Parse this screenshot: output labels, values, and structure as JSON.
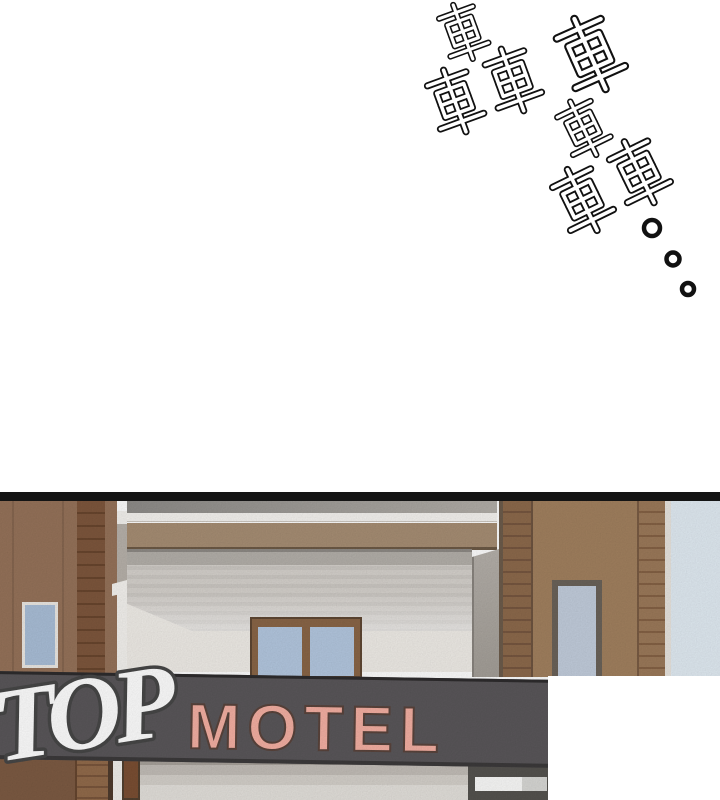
{
  "page": {
    "background": "#ffffff"
  },
  "sfx": {
    "text": "轟車轟",
    "label": "rumble sound effect 轟車轟 with trailing dots",
    "dots": 3
  },
  "panel": {
    "sign": {
      "script_word": "TOP",
      "word": "MOTEL"
    },
    "colors": {
      "sign_band": "#5a575a",
      "sign_letters": "#f5b0a3",
      "script_letters": "#ffffff",
      "brick": "#8d6a4c",
      "tan_wall": "#a2815f",
      "canopy": "#d6d2cd",
      "sky": "#e2ecf4",
      "window_glass": "#b4c8e0",
      "top_border": "#141414"
    }
  }
}
